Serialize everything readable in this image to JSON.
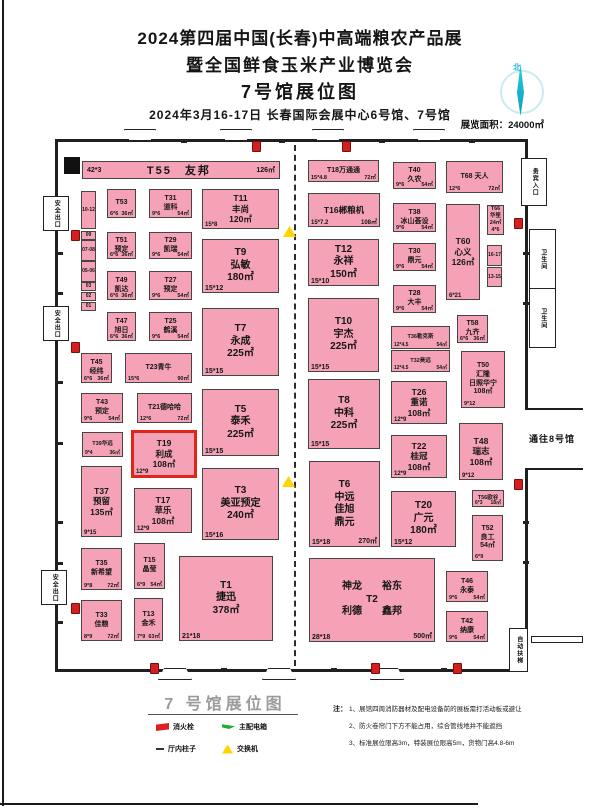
{
  "header": {
    "title_line1": "2024第四届中国(长春)中高端粮农产品展",
    "title_line2": "暨全国鲜食玉米产业博览会",
    "title_line3": "7号馆展位图",
    "subtitle": "2024年3月16-17日  长春国际会展中心6号馆、7号馆"
  },
  "compass_label": "北",
  "area_label": "展览面积：24000㎡",
  "colors": {
    "booth_pink": "#f5a2b6",
    "highlight_red": "#e0251b",
    "compass_cyan": "#1ec3d9",
    "hydrant_red": "#d21f1f",
    "switch_yellow": "#ffd400",
    "power_green": "#1faa30"
  },
  "plan": {
    "booths": [
      {
        "id": "T55",
        "x": 82,
        "y": 161,
        "w": 198,
        "h": 18,
        "cls": "bar",
        "sz": "m",
        "lines": [
          "T55　友邦"
        ],
        "fl": "42*3",
        "fr": "126㎡"
      },
      {
        "id": "T53",
        "x": 107,
        "y": 189,
        "w": 29,
        "h": 29,
        "sz": "s",
        "lines": [
          "T53"
        ],
        "fl": "6*6",
        "fr": "36㎡"
      },
      {
        "id": "T51",
        "x": 107,
        "y": 232,
        "w": 29,
        "h": 27,
        "sz": "s",
        "lines": [
          "T51",
          "预定"
        ],
        "fl": "6*6",
        "fr": "36㎡"
      },
      {
        "id": "T49",
        "x": 107,
        "y": 271,
        "w": 29,
        "h": 29,
        "sz": "s",
        "lines": [
          "T49",
          "凯达"
        ],
        "fl": "6*6",
        "fr": "36㎡"
      },
      {
        "id": "T47",
        "x": 107,
        "y": 312,
        "w": 29,
        "h": 29,
        "sz": "s",
        "lines": [
          "T47",
          "旭日"
        ],
        "fl": "6*6",
        "fr": "36㎡"
      },
      {
        "id": "T45",
        "x": 81,
        "y": 353,
        "w": 31,
        "h": 30,
        "sz": "s",
        "lines": [
          "T45",
          "经纬"
        ],
        "fl": "6*6",
        "fr": "36㎡"
      },
      {
        "id": "T31",
        "x": 149,
        "y": 189,
        "w": 43,
        "h": 29,
        "sz": "s",
        "lines": [
          "T31",
          "道科"
        ],
        "fl": "9*6",
        "fr": "54㎡"
      },
      {
        "id": "T29",
        "x": 149,
        "y": 232,
        "w": 43,
        "h": 27,
        "sz": "s",
        "lines": [
          "T29",
          "凯瑞"
        ],
        "fl": "9*6",
        "fr": "54㎡"
      },
      {
        "id": "T27",
        "x": 149,
        "y": 271,
        "w": 43,
        "h": 29,
        "sz": "s",
        "lines": [
          "T27",
          "预定"
        ],
        "fl": "9*6",
        "fr": "54㎡"
      },
      {
        "id": "T25",
        "x": 149,
        "y": 312,
        "w": 43,
        "h": 29,
        "sz": "s",
        "lines": [
          "T25",
          "鹤溪"
        ],
        "fl": "9*6",
        "fr": "54㎡"
      },
      {
        "id": "T23",
        "x": 125,
        "y": 353,
        "w": 67,
        "h": 30,
        "sz": "s",
        "lines": [
          "T23青牛"
        ],
        "fl": "15*6",
        "fr": "90㎡"
      },
      {
        "id": "T43",
        "x": 81,
        "y": 393,
        "w": 42,
        "h": 30,
        "sz": "s",
        "lines": [
          "T43",
          "预定"
        ],
        "fl": "9*6",
        "fr": "54㎡"
      },
      {
        "id": "T21",
        "x": 137,
        "y": 393,
        "w": 55,
        "h": 30,
        "sz": "s",
        "lines": [
          "T21德哈哈"
        ],
        "fl": "12*6",
        "fr": "72㎡"
      },
      {
        "id": "T39",
        "x": 82,
        "y": 432,
        "w": 41,
        "h": 25,
        "sz": "xs",
        "lines": [
          "T39华远"
        ],
        "fl": "9*4",
        "fr": "36㎡"
      },
      {
        "id": "T19",
        "x": 131,
        "y": 430,
        "w": 66,
        "h": 48,
        "sz": "m",
        "hi": true,
        "lines": [
          "T19",
          "利成",
          "108㎡"
        ],
        "fl": "12*9"
      },
      {
        "id": "T37",
        "x": 81,
        "y": 466,
        "w": 41,
        "h": 71,
        "sz": "m",
        "lines": [
          "T37",
          "预留",
          "135㎡"
        ],
        "fl": "9*15"
      },
      {
        "id": "T17",
        "x": 134,
        "y": 488,
        "w": 58,
        "h": 45,
        "sz": "m",
        "lines": [
          "T17",
          "草乐",
          "108㎡"
        ],
        "fl": "12*9"
      },
      {
        "id": "T35",
        "x": 81,
        "y": 548,
        "w": 41,
        "h": 42,
        "sz": "s",
        "lines": [
          "T35",
          "新希望"
        ],
        "fl": "9*8",
        "fr": "72㎡"
      },
      {
        "id": "T15",
        "x": 134,
        "y": 543,
        "w": 31,
        "h": 46,
        "sz": "s",
        "lines": [
          "T15",
          "晶莹"
        ],
        "fl": "6*9",
        "fr": "54㎡"
      },
      {
        "id": "T33",
        "x": 81,
        "y": 600,
        "w": 41,
        "h": 41,
        "sz": "s",
        "lines": [
          "T33",
          "佳粮"
        ],
        "fl": "8*9",
        "fr": "72㎡"
      },
      {
        "id": "T13",
        "x": 134,
        "y": 598,
        "w": 29,
        "h": 43,
        "sz": "s",
        "lines": [
          "T13",
          "金禾"
        ],
        "fl": "7*9",
        "fr": "63㎡"
      },
      {
        "id": "T11",
        "x": 202,
        "y": 189,
        "w": 77,
        "h": 40,
        "sz": "m",
        "lines": [
          "T11",
          "丰尚",
          "120㎡"
        ],
        "fl": "15*8"
      },
      {
        "id": "T9",
        "x": 202,
        "y": 239,
        "w": 77,
        "h": 54,
        "sz": "l",
        "lines": [
          "T9",
          "弘敏",
          "180㎡"
        ],
        "fl": "15*12"
      },
      {
        "id": "T7",
        "x": 202,
        "y": 308,
        "w": 77,
        "h": 68,
        "sz": "l",
        "lines": [
          "T7",
          "永成",
          "225㎡"
        ],
        "fl": "15*15"
      },
      {
        "id": "T5",
        "x": 202,
        "y": 389,
        "w": 77,
        "h": 67,
        "sz": "l",
        "lines": [
          "T5",
          "泰禾",
          "225㎡"
        ],
        "fl": "15*15"
      },
      {
        "id": "T3",
        "x": 202,
        "y": 468,
        "w": 77,
        "h": 72,
        "sz": "l",
        "lines": [
          "T3",
          "美亚预定",
          "240㎡"
        ],
        "fl": "15*16"
      },
      {
        "id": "T1",
        "x": 179,
        "y": 556,
        "w": 94,
        "h": 85,
        "sz": "l",
        "lines": [
          "T1",
          "捷迅",
          "378㎡"
        ],
        "fl": "21*18"
      },
      {
        "id": "T18",
        "x": 308,
        "y": 160,
        "w": 71,
        "h": 22,
        "sz": "s",
        "lines": [
          "T18万通通"
        ],
        "fl": "15*4.8",
        "fr": "72㎡"
      },
      {
        "id": "T16",
        "x": 308,
        "y": 193,
        "w": 72,
        "h": 34,
        "sz": "m",
        "lines": [
          "T16郴粮机"
        ],
        "fl": "15*7.2",
        "fr": "108㎡"
      },
      {
        "id": "T12",
        "x": 308,
        "y": 239,
        "w": 71,
        "h": 47,
        "sz": "l",
        "lines": [
          "T12",
          "永祥",
          "150㎡"
        ],
        "fl": "15*10"
      },
      {
        "id": "T10",
        "x": 308,
        "y": 298,
        "w": 71,
        "h": 74,
        "sz": "l",
        "lines": [
          "T10",
          "宇杰",
          "225㎡"
        ],
        "fl": "15*15"
      },
      {
        "id": "T8",
        "x": 308,
        "y": 379,
        "w": 72,
        "h": 70,
        "sz": "l",
        "lines": [
          "T8",
          "中科",
          "225㎡"
        ],
        "fl": "15*15"
      },
      {
        "id": "T6",
        "x": 309,
        "y": 461,
        "w": 71,
        "h": 86,
        "sz": "l",
        "lines": [
          "T6",
          "中远",
          "佳旭",
          "鼎元"
        ],
        "fl": "15*18",
        "fr": "270㎡"
      },
      {
        "id": "T20",
        "x": 391,
        "y": 491,
        "w": 65,
        "h": 56,
        "sz": "l",
        "lines": [
          "T20",
          "广元",
          "180㎡"
        ],
        "fl": "15*12"
      },
      {
        "id": "T2",
        "x": 309,
        "y": 558,
        "w": 126,
        "h": 84,
        "sz": "l",
        "lines": [
          "神龙　　裕东",
          "T2",
          "利德　　鑫邦"
        ],
        "fl": "28*18",
        "fr": "500㎡"
      },
      {
        "id": "T40",
        "x": 393,
        "y": 162,
        "w": 43,
        "h": 27,
        "sz": "s",
        "lines": [
          "T40",
          "久农"
        ],
        "fl": "9*6",
        "fr": "54㎡"
      },
      {
        "id": "T38",
        "x": 393,
        "y": 203,
        "w": 43,
        "h": 29,
        "sz": "s",
        "lines": [
          "T38",
          "冰山荟设"
        ],
        "fl": "9*6",
        "fr": "54㎡"
      },
      {
        "id": "T30",
        "x": 393,
        "y": 243,
        "w": 43,
        "h": 28,
        "sz": "s",
        "lines": [
          "T30",
          "鼎元"
        ],
        "fl": "9*6",
        "fr": "54㎡"
      },
      {
        "id": "T28",
        "x": 393,
        "y": 285,
        "w": 43,
        "h": 28,
        "sz": "s",
        "lines": [
          "T28",
          "大丰"
        ],
        "fl": "9*6",
        "fr": "54㎡"
      },
      {
        "id": "T36",
        "x": 391,
        "y": 326,
        "w": 59,
        "h": 23,
        "sz": "xs",
        "lines": [
          "T36勒克斯"
        ],
        "fl": "12*4.5",
        "fr": "54㎡"
      },
      {
        "id": "T32",
        "x": 391,
        "y": 350,
        "w": 59,
        "h": 22,
        "sz": "xs",
        "lines": [
          "T32昊远"
        ],
        "fl": "12*4.5",
        "fr": "54㎡"
      },
      {
        "id": "T26",
        "x": 391,
        "y": 381,
        "w": 56,
        "h": 43,
        "sz": "m",
        "lines": [
          "T26",
          "重诺",
          "108㎡"
        ],
        "fl": "12*9"
      },
      {
        "id": "T22",
        "x": 391,
        "y": 435,
        "w": 56,
        "h": 43,
        "sz": "m",
        "lines": [
          "T22",
          "桂冠",
          "108㎡"
        ],
        "fl": "12*9"
      },
      {
        "id": "T68",
        "x": 446,
        "y": 161,
        "w": 57,
        "h": 32,
        "sz": "s",
        "lines": [
          "T68 天人"
        ],
        "fl": "12*6",
        "fr": "72㎡"
      },
      {
        "id": "T66",
        "x": 487,
        "y": 205,
        "w": 17,
        "h": 30,
        "sz": "xs",
        "lines": [
          "T66",
          "华笙",
          "24㎡",
          "4*6"
        ]
      },
      {
        "id": "T60",
        "x": 446,
        "y": 204,
        "w": 34,
        "h": 96,
        "sz": "m",
        "lines": [
          "T60",
          "心义",
          "126㎡"
        ],
        "fl": "6*21"
      },
      {
        "id": "B16-17",
        "x": 487,
        "y": 245,
        "w": 15,
        "h": 21,
        "cls": "cell",
        "lines": [
          "16-17"
        ]
      },
      {
        "id": "B13-15",
        "x": 487,
        "y": 267,
        "w": 15,
        "h": 20,
        "cls": "cell",
        "lines": [
          "13-15"
        ]
      },
      {
        "id": "T58",
        "x": 457,
        "y": 315,
        "w": 31,
        "h": 28,
        "sz": "s",
        "lines": [
          "T58",
          "九齐"
        ],
        "fl": "6*6",
        "fr": "36㎡"
      },
      {
        "id": "T50",
        "x": 461,
        "y": 351,
        "w": 44,
        "h": 57,
        "sz": "s",
        "lines": [
          "T50",
          "汇隆",
          "日照华宁",
          "108㎡"
        ],
        "fl": "9*12"
      },
      {
        "id": "T48",
        "x": 459,
        "y": 423,
        "w": 44,
        "h": 57,
        "sz": "m",
        "lines": [
          "T48",
          "瑞志",
          "108㎡"
        ],
        "fl": "9*12"
      },
      {
        "id": "T56",
        "x": 472,
        "y": 490,
        "w": 32,
        "h": 17,
        "sz": "xs",
        "lines": [
          "T56欧谷"
        ],
        "fl": "6*3",
        "fr": "18㎡"
      },
      {
        "id": "T52",
        "x": 472,
        "y": 515,
        "w": 31,
        "h": 46,
        "sz": "s",
        "lines": [
          "T52",
          "良工",
          "54㎡"
        ],
        "fl": "6*9"
      },
      {
        "id": "T46",
        "x": 446,
        "y": 571,
        "w": 42,
        "h": 31,
        "sz": "s",
        "lines": [
          "T46",
          "永泰"
        ],
        "fl": "9*6",
        "fr": "54㎡"
      },
      {
        "id": "T42",
        "x": 446,
        "y": 611,
        "w": 42,
        "h": 31,
        "sz": "s",
        "lines": [
          "T42",
          "纳康"
        ],
        "fl": "9*6",
        "fr": "54㎡"
      },
      {
        "id": "C10-12",
        "x": 81,
        "y": 191,
        "w": 15,
        "h": 38,
        "cls": "cell",
        "lines": [
          "10-12"
        ]
      },
      {
        "id": "C09",
        "x": 81,
        "y": 231,
        "w": 15,
        "h": 9,
        "cls": "cell",
        "lines": [
          "09"
        ]
      },
      {
        "id": "C07-08",
        "x": 81,
        "y": 240,
        "w": 15,
        "h": 21,
        "cls": "cell",
        "lines": [
          "07-08"
        ]
      },
      {
        "id": "C05-06",
        "x": 81,
        "y": 261,
        "w": 15,
        "h": 21,
        "cls": "cell",
        "lines": [
          "05-06"
        ]
      },
      {
        "id": "C03",
        "x": 81,
        "y": 282,
        "w": 15,
        "h": 9,
        "cls": "cell",
        "lines": [
          "03"
        ]
      },
      {
        "id": "C02",
        "x": 81,
        "y": 292,
        "w": 15,
        "h": 9,
        "cls": "cell",
        "lines": [
          "02"
        ]
      },
      {
        "id": "C01",
        "x": 81,
        "y": 302,
        "w": 15,
        "h": 9,
        "cls": "cell",
        "lines": [
          "01"
        ]
      }
    ],
    "facilities": [
      {
        "text": "安全出口",
        "name": "safety-exit-label",
        "x": 43,
        "y": 196,
        "w": 24,
        "h": 33,
        "v": true,
        "box": true
      },
      {
        "text": "安全出口",
        "name": "safety-exit-label",
        "x": 43,
        "y": 306,
        "w": 24,
        "h": 33,
        "v": true,
        "box": true
      },
      {
        "text": "安全出口",
        "name": "safety-exit-label",
        "x": 41,
        "y": 570,
        "w": 24,
        "h": 33,
        "v": true,
        "box": true
      },
      {
        "text": "贵宾入口",
        "name": "vip-entrance-label",
        "x": 521,
        "y": 158,
        "w": 24,
        "h": 46,
        "v": true,
        "box": true
      },
      {
        "text": "卫生间",
        "name": "restroom-label",
        "x": 529,
        "y": 229,
        "w": 25,
        "h": 58,
        "v": true,
        "box": true
      },
      {
        "text": "卫生间",
        "name": "restroom-label",
        "x": 529,
        "y": 288,
        "w": 25,
        "h": 58,
        "v": true,
        "box": true
      },
      {
        "text": "自动扶梯",
        "name": "escalator-label",
        "x": 509,
        "y": 628,
        "w": 17,
        "h": 42,
        "v": true,
        "box": true
      },
      {
        "text": "通往8号馆",
        "name": "to-hall8-label",
        "x": 524,
        "y": 433,
        "w": 56,
        "h": 14,
        "v": false,
        "box": false,
        "big": true
      }
    ],
    "doors_top": [
      124,
      220,
      312,
      413
    ],
    "doors_bottom": [
      158,
      262,
      370
    ],
    "hydrants": [
      [
        252,
        141
      ],
      [
        342,
        141
      ],
      [
        71,
        230
      ],
      [
        71,
        342
      ],
      [
        71,
        603
      ],
      [
        514,
        218
      ],
      [
        514,
        479
      ],
      [
        150,
        663
      ],
      [
        371,
        663
      ],
      [
        453,
        663
      ]
    ],
    "switches": [
      [
        283,
        226
      ],
      [
        282,
        476
      ]
    ],
    "ticks": [
      [
        57,
        252
      ],
      [
        57,
        292
      ],
      [
        57,
        381
      ],
      [
        57,
        442
      ],
      [
        57,
        521
      ],
      [
        57,
        562
      ],
      [
        57,
        621
      ],
      [
        523,
        252
      ],
      [
        523,
        302
      ],
      [
        523,
        521
      ],
      [
        523,
        561
      ],
      [
        181,
        140
      ],
      [
        279,
        140
      ],
      [
        379,
        140
      ],
      [
        469,
        140
      ],
      [
        221,
        668
      ],
      [
        331,
        668
      ],
      [
        441,
        668
      ]
    ]
  },
  "legend": {
    "title": "7 号馆展位图",
    "items": [
      {
        "label": "消火栓",
        "icon": "hydrant-flag"
      },
      {
        "label": "主配电箱",
        "icon": "power-flag"
      },
      {
        "label": "厅内柱子",
        "icon": "pillar-dash"
      },
      {
        "label": "交换机",
        "icon": "switch-triangle"
      }
    ]
  },
  "notes": {
    "label": "注：",
    "items": [
      "1、展馆四周消防器材及配电设备前的展板需打活动板或避让",
      "2、防火卷帘门下方不能占用，综合管线地井不能遮挡",
      "3、标准展位限高3m，特装展位限高5m，货物门高4.8-6m"
    ]
  }
}
